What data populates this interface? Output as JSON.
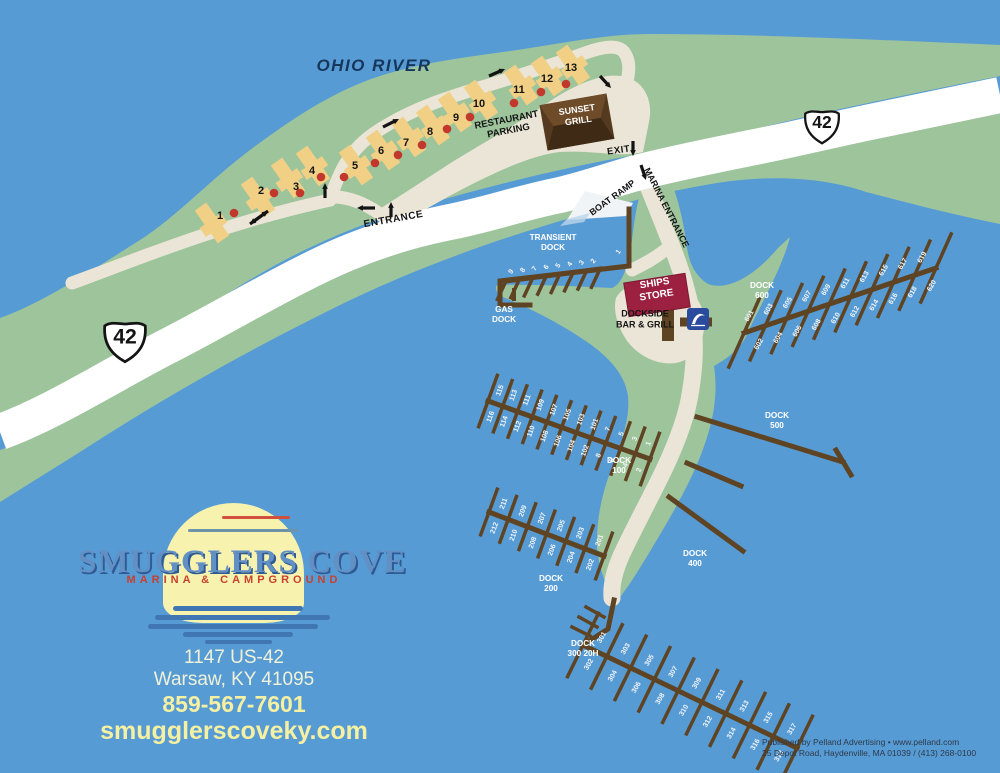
{
  "river_label": "OHIO RIVER",
  "colors": {
    "water": "#579BD5",
    "land": "#9EC49C",
    "road_white": "#FFFFFF",
    "road_beige": "#EAE5D6",
    "dock": "#5E4423",
    "campsite": "#F1D086",
    "site_dot": "#C2382B",
    "grill_brown": "#553A20",
    "ships_store": "#9C2040",
    "sign_blue": "#2B4C9E",
    "label_white": "#F3F5F7",
    "label_dark": "#141414",
    "river_text": "#16365C"
  },
  "shields": [
    {
      "name": "us-42-shield-west",
      "label": "42",
      "x": 125,
      "y": 336,
      "s": 46
    },
    {
      "name": "us-42-shield-east",
      "label": "42",
      "x": 822,
      "y": 122,
      "s": 38
    }
  ],
  "labels": [
    {
      "id": "ohio-river",
      "lines": [
        "OHIO RIVER"
      ],
      "x": 374,
      "y": 71,
      "size": 17,
      "fill": "#16365C",
      "style": "italic",
      "spacing": 1.5,
      "rot": 0
    },
    {
      "id": "entrance",
      "lines": [
        "ENTRANCE"
      ],
      "x": 394,
      "y": 222,
      "size": 10,
      "fill": "#141414",
      "rot": -10,
      "spacing": 0.6
    },
    {
      "id": "exit",
      "lines": [
        "EXIT"
      ],
      "x": 619,
      "y": 153,
      "size": 9.5,
      "fill": "#141414",
      "rot": -8,
      "spacing": 0.5
    },
    {
      "id": "restaurant-parking",
      "lines": [
        "RESTAURANT",
        "PARKING"
      ],
      "x": 508,
      "y": 128,
      "size": 9.5,
      "fill": "#141414",
      "rot": -11,
      "lh": 11
    },
    {
      "id": "boat-ramp",
      "lines": [
        "BOAT RAMP"
      ],
      "x": 614,
      "y": 200,
      "size": 9,
      "fill": "#141414",
      "rot": -36
    },
    {
      "id": "marina-entrance",
      "lines": [
        "MARINA ENTRANCE"
      ],
      "x": 664,
      "y": 209,
      "size": 9,
      "fill": "#141414",
      "rot": 63
    },
    {
      "id": "sunset-grill",
      "lines": [
        "SUNSET",
        "GRILL"
      ],
      "x": 578,
      "y": 118,
      "size": 9,
      "fill": "#FFFFFF",
      "rot": -8,
      "lh": 11
    },
    {
      "id": "ships-store",
      "lines": [
        "SHIPS",
        "STORE"
      ],
      "x": 656,
      "y": 292,
      "size": 10,
      "fill": "#FFFFFF",
      "rot": -9,
      "lh": 12
    },
    {
      "id": "dockside-bar-grill",
      "lines": [
        "DOCKSIDE",
        "BAR & GRILL"
      ],
      "x": 645,
      "y": 322,
      "size": 9,
      "fill": "#141414",
      "lh": 11
    },
    {
      "id": "transient-dock",
      "lines": [
        "TRANSIENT",
        "DOCK"
      ],
      "x": 553,
      "y": 245,
      "size": 8.2,
      "fill": "#FFFFFF",
      "lh": 10
    },
    {
      "id": "gas-dock",
      "lines": [
        "GAS",
        "DOCK"
      ],
      "x": 504,
      "y": 317,
      "size": 8.2,
      "fill": "#FFFFFF",
      "lh": 10
    },
    {
      "id": "dock-600",
      "lines": [
        "DOCK",
        "600"
      ],
      "x": 762,
      "y": 293,
      "size": 8.2,
      "fill": "#FFFFFF",
      "lh": 10
    },
    {
      "id": "dock-500",
      "lines": [
        "DOCK",
        "500"
      ],
      "x": 777,
      "y": 423,
      "size": 8.2,
      "fill": "#FFFFFF",
      "lh": 10
    },
    {
      "id": "dock-100",
      "lines": [
        "DOCK",
        "100"
      ],
      "x": 619,
      "y": 468,
      "size": 8.2,
      "fill": "#FFFFFF",
      "lh": 10
    },
    {
      "id": "dock-400",
      "lines": [
        "DOCK",
        "400"
      ],
      "x": 695,
      "y": 561,
      "size": 8.2,
      "fill": "#FFFFFF",
      "lh": 10
    },
    {
      "id": "dock-200",
      "lines": [
        "DOCK",
        "200"
      ],
      "x": 551,
      "y": 586,
      "size": 8.2,
      "fill": "#FFFFFF",
      "lh": 10
    },
    {
      "id": "dock-300",
      "lines": [
        "DOCK",
        "300 20H"
      ],
      "x": 583,
      "y": 651,
      "size": 8.2,
      "fill": "#FFFFFF",
      "lh": 10
    },
    {
      "id": "transient-slip-1",
      "lines": [
        "1"
      ],
      "x": 620,
      "y": 253,
      "size": 7,
      "fill": "#F3F5F7",
      "rot": -55
    }
  ],
  "campsites": [
    {
      "n": "1",
      "bx": 212,
      "by": 223,
      "nx": 220,
      "ny": 215,
      "dx": 234,
      "dy": 213
    },
    {
      "n": "2",
      "bx": 258,
      "by": 197,
      "nx": 261,
      "ny": 190,
      "dx": 274,
      "dy": 193
    },
    {
      "n": "3",
      "bx": 288,
      "by": 178,
      "nx": 296,
      "ny": 186,
      "dx": 300,
      "dy": 193
    },
    {
      "n": "4",
      "bx": 313,
      "by": 166,
      "nx": 312,
      "ny": 170,
      "dx": 321,
      "dy": 177
    },
    {
      "n": "5",
      "bx": 356,
      "by": 165,
      "nx": 355,
      "ny": 165,
      "dx": 344,
      "dy": 177
    },
    {
      "n": "6",
      "bx": 383,
      "by": 150,
      "nx": 381,
      "ny": 150,
      "dx": 375,
      "dy": 163
    },
    {
      "n": "7",
      "bx": 409,
      "by": 137,
      "nx": 406,
      "ny": 142,
      "dx": 398,
      "dy": 155
    },
    {
      "n": "8",
      "bx": 433,
      "by": 125,
      "nx": 430,
      "ny": 131,
      "dx": 422,
      "dy": 145
    },
    {
      "n": "9",
      "bx": 455,
      "by": 112,
      "nx": 456,
      "ny": 117,
      "dx": 447,
      "dy": 129
    },
    {
      "n": "10",
      "bx": 481,
      "by": 100,
      "nx": 479,
      "ny": 103,
      "dx": 470,
      "dy": 117
    },
    {
      "n": "11",
      "bx": 521,
      "by": 85,
      "nx": 519,
      "ny": 89,
      "dx": 514,
      "dy": 103
    },
    {
      "n": "12",
      "bx": 548,
      "by": 76,
      "nx": 547,
      "ny": 78,
      "dx": 541,
      "dy": 92
    },
    {
      "n": "13",
      "bx": 573,
      "by": 65,
      "nx": 571,
      "ny": 67,
      "dx": 566,
      "dy": 84
    }
  ],
  "arrows": [
    {
      "x1": 250,
      "y1": 224,
      "x2": 268,
      "y2": 211,
      "double": true
    },
    {
      "x1": 325,
      "y1": 198,
      "x2": 325,
      "y2": 183
    },
    {
      "x1": 375,
      "y1": 208,
      "x2": 357,
      "y2": 208
    },
    {
      "x1": 391,
      "y1": 217,
      "x2": 391,
      "y2": 202
    },
    {
      "x1": 383,
      "y1": 127,
      "x2": 399,
      "y2": 119
    },
    {
      "x1": 489,
      "y1": 76,
      "x2": 505,
      "y2": 69
    },
    {
      "x1": 600,
      "y1": 76,
      "x2": 611,
      "y2": 88
    },
    {
      "x1": 633,
      "y1": 141,
      "x2": 633,
      "y2": 156
    },
    {
      "x1": 641,
      "y1": 165,
      "x2": 646,
      "y2": 180
    }
  ],
  "docks": {
    "lines": [
      {
        "id": "transient-main",
        "pts": [
          [
            629,
            209
          ],
          [
            629,
            266
          ],
          [
            500,
            281
          ],
          [
            500,
            305
          ],
          [
            530,
            305
          ]
        ],
        "w": 5
      },
      {
        "id": "gas-stub",
        "pts": [
          [
            514,
            299
          ],
          [
            514,
            290
          ]
        ],
        "w": 4
      },
      {
        "id": "dock-500-walkway",
        "pts": [
          [
            697,
            417
          ],
          [
            843,
            462
          ]
        ],
        "w": 5
      },
      {
        "id": "dock-500-thead",
        "pts": [
          [
            836,
            450
          ],
          [
            851,
            475
          ]
        ],
        "w": 5
      },
      {
        "id": "dock-400-upper",
        "pts": [
          [
            687,
            463
          ],
          [
            741,
            486
          ]
        ],
        "w": 5
      },
      {
        "id": "dock-400-lower",
        "pts": [
          [
            669,
            497
          ],
          [
            743,
            551
          ]
        ],
        "w": 5
      },
      {
        "id": "dock-300-approach",
        "pts": [
          [
            614,
            600
          ],
          [
            608,
            629
          ],
          [
            583,
            645
          ]
        ],
        "w": 5
      },
      {
        "id": "dock-300-tie1",
        "pts": [
          [
            604,
            617
          ],
          [
            586,
            607
          ]
        ],
        "w": 3.5
      },
      {
        "id": "dock-300-tie2",
        "pts": [
          [
            597,
            627
          ],
          [
            579,
            617
          ]
        ],
        "w": 3.5
      },
      {
        "id": "dock-300-tie3",
        "pts": [
          [
            590,
            636
          ],
          [
            572,
            627
          ]
        ],
        "w": 3.5
      }
    ],
    "fingered": [
      {
        "id": "dock-600",
        "p1": [
          744,
          333
        ],
        "p2": [
          936,
          268
        ],
        "n": 10,
        "len": 78,
        "fa": -66,
        "off": 15,
        "tr": -60,
        "a": [
          "601",
          "603",
          "605",
          "607",
          "609",
          "611",
          "613",
          "615",
          "617",
          "619"
        ],
        "b": [
          "602",
          "604",
          "606",
          "608",
          "610",
          "612",
          "614",
          "616",
          "618",
          "620"
        ]
      },
      {
        "id": "dock-100",
        "p1": [
          650,
          459
        ],
        "p2": [
          488,
          401
        ],
        "n": 12,
        "len": 58,
        "fa": -70,
        "off": 14,
        "tr": -70,
        "a": [
          "1",
          "3",
          "5",
          "7",
          "101",
          "103",
          "105",
          "107",
          "109",
          "111",
          "113",
          "115"
        ],
        "b": [
          "2",
          "4",
          "6",
          "8",
          "102",
          "104",
          "106",
          "108",
          "110",
          "112",
          "114",
          "116"
        ]
      },
      {
        "id": "dock-200",
        "p1": [
          604,
          556
        ],
        "p2": [
          489,
          512
        ],
        "n": 7,
        "len": 52,
        "fa": -70,
        "off": 13,
        "tr": -70,
        "a": [
          "201",
          "203",
          "205",
          "207",
          "209",
          "211"
        ],
        "b": [
          "202",
          "204",
          "206",
          "208",
          "210",
          "212"
        ]
      },
      {
        "id": "dock-300",
        "p1": [
          583,
          645
        ],
        "p2": [
          797,
          748
        ],
        "n": 10,
        "len": 74,
        "fa": -64,
        "off": 15,
        "tr": -60,
        "a": [
          "301",
          "303",
          "305",
          "307",
          "309",
          "311",
          "313",
          "315",
          "317"
        ],
        "b": [
          "302",
          "304",
          "306",
          "308",
          "310",
          "312",
          "314",
          "316",
          "318"
        ]
      },
      {
        "id": "transient-dock-fingers",
        "p1": [
          600,
          269
        ],
        "p2": [
          506,
          281
        ],
        "n": 8,
        "len": 22,
        "fa": 115,
        "off": 9,
        "tr": -55,
        "oneSide": true,
        "a": [
          "2",
          "3",
          "4",
          "5",
          "6",
          "7",
          "8",
          "9"
        ],
        "b": []
      }
    ]
  },
  "logo": {
    "name": "SMUGGLERS COVE",
    "tagline": "MARINA & CAMPGROUND"
  },
  "contact": {
    "address1": "1147 US-42",
    "address2": "Warsaw, KY 41095",
    "phone": "859-567-7601",
    "website": "smugglerscoveky.com"
  },
  "publisher": {
    "line1": "Published by Pelland Advertising • www.pelland.com",
    "line2": "25 Depot Road, Haydenville, MA 01039 / (413) 268-0100"
  }
}
